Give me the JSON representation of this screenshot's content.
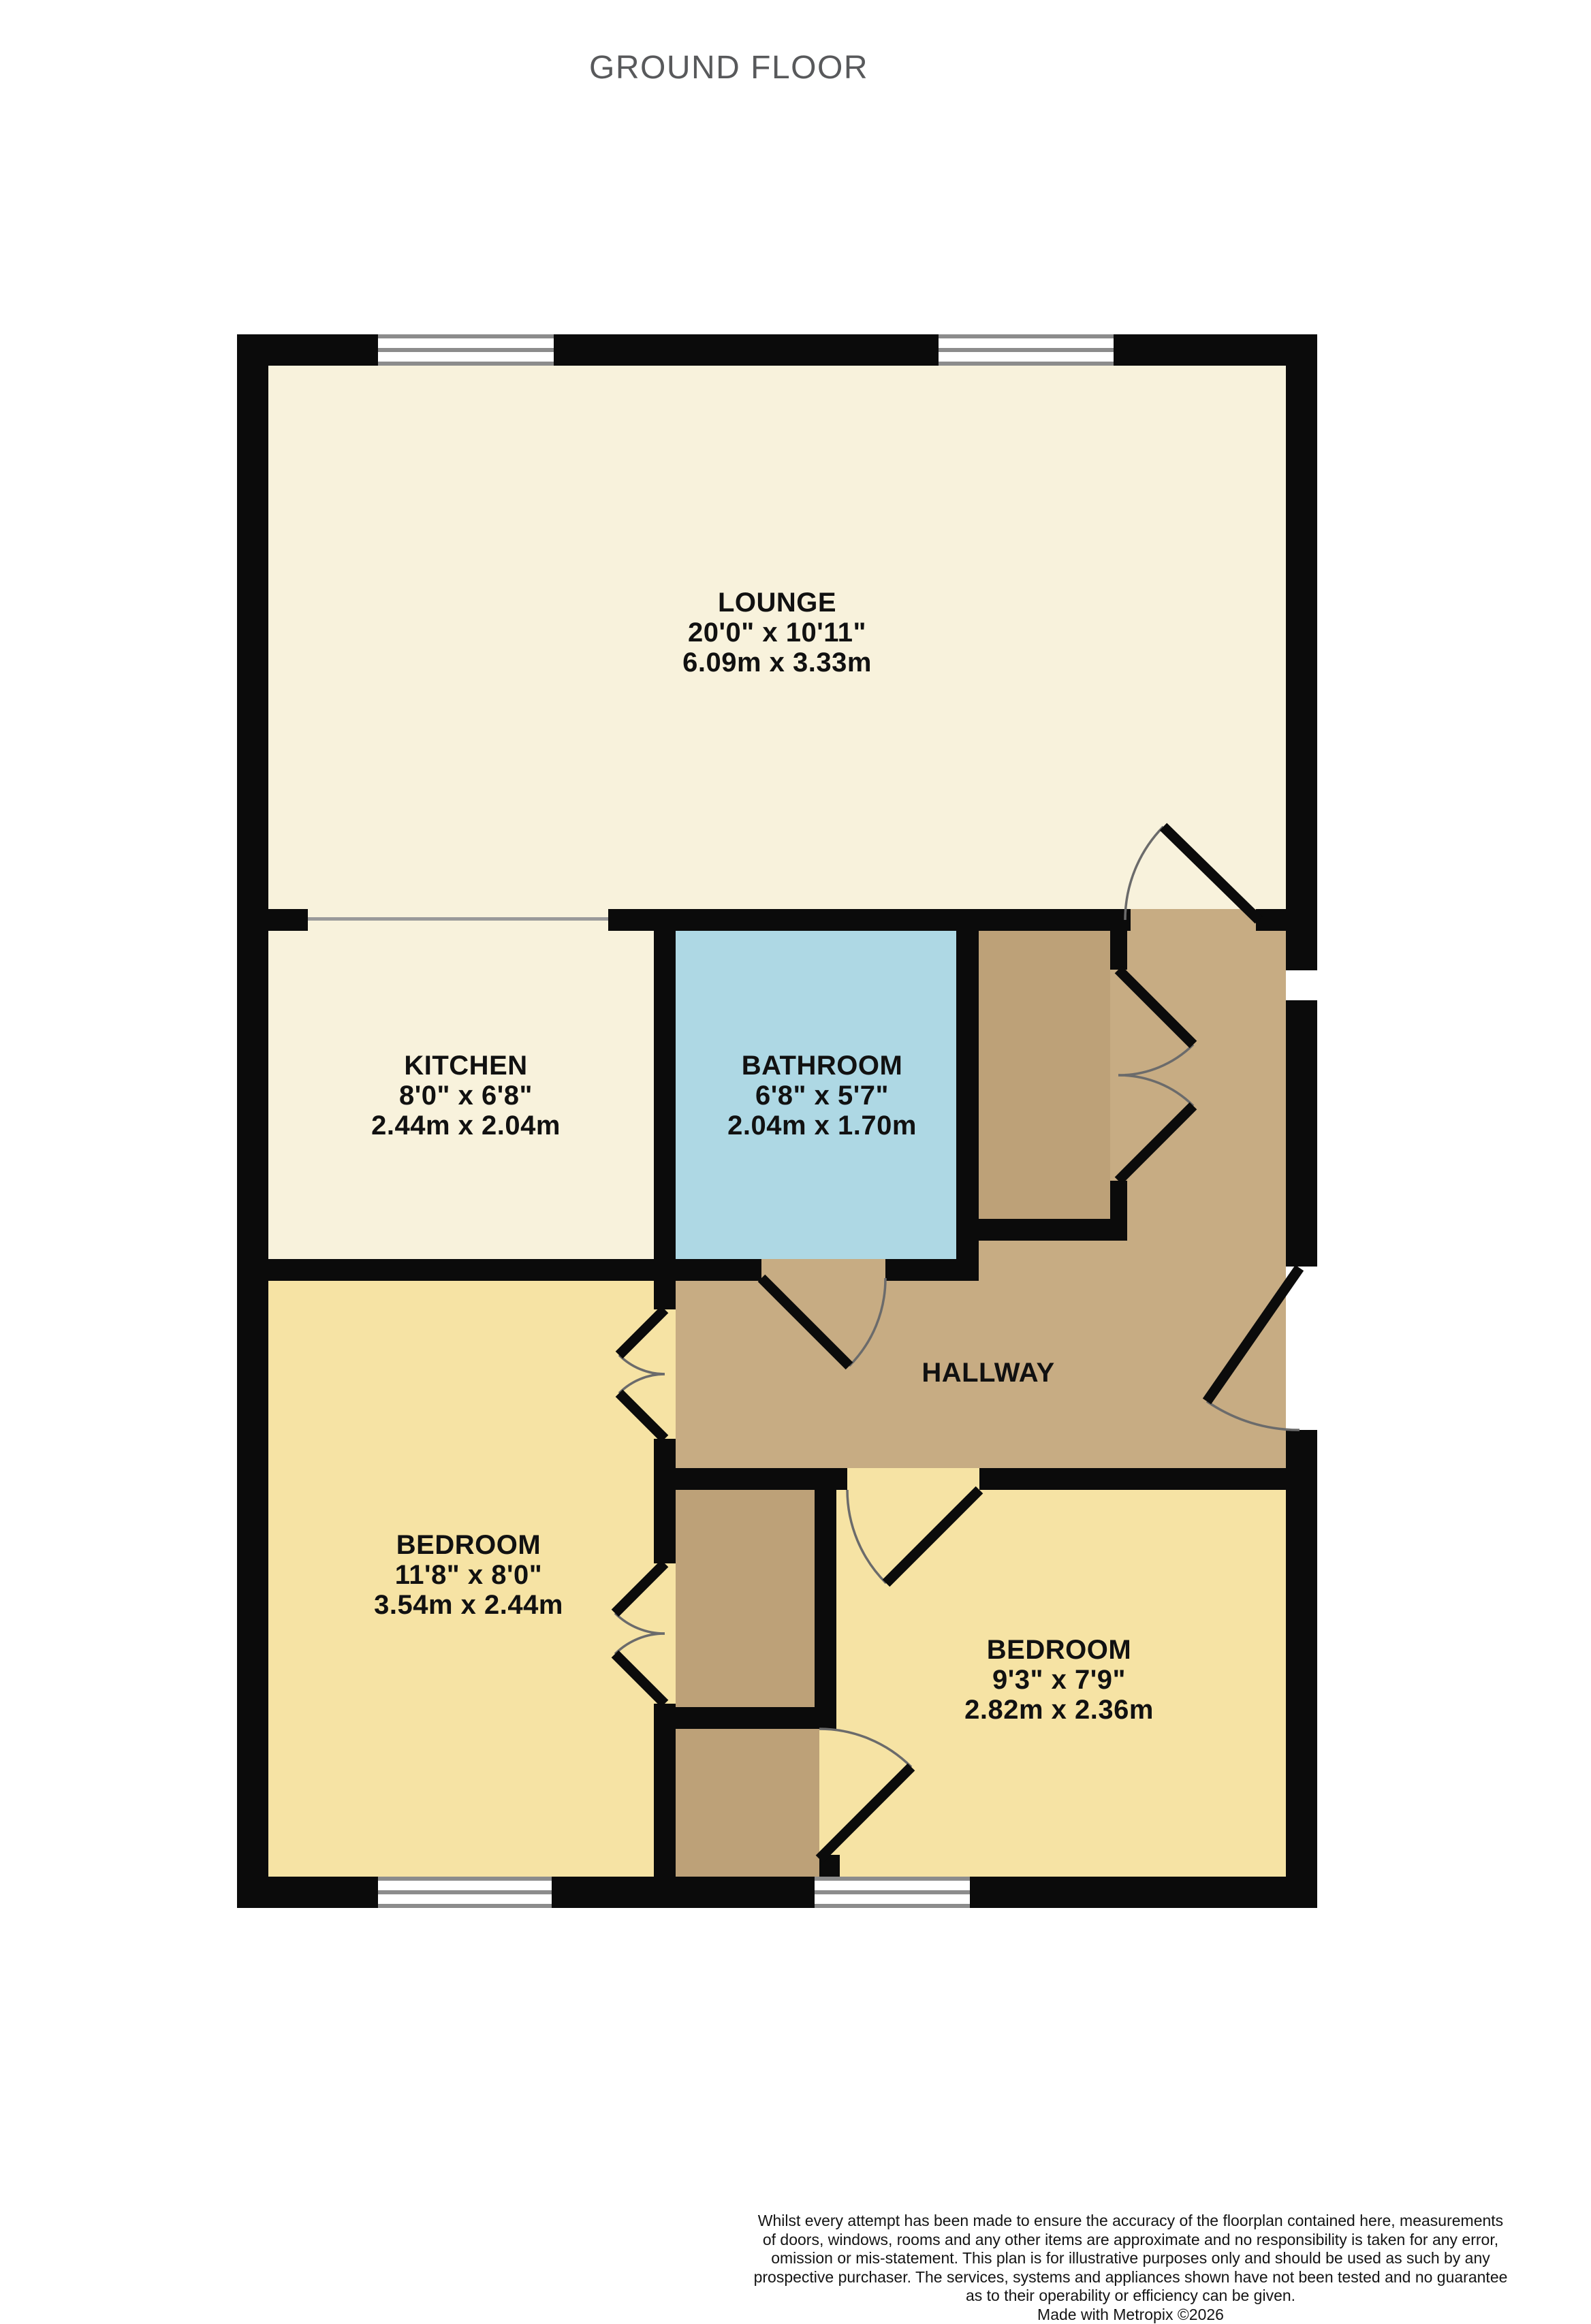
{
  "title": "GROUND FLOOR",
  "colors": {
    "wall": "#0b0b0b",
    "cream": "#f8f2dc",
    "blue": "#aed8e4",
    "tan": "#c7ac83",
    "cupboard_tan": "#bda178",
    "yellow": "#f6e3a4",
    "window_frame": "#8c8c8c",
    "title_gray": "#58595b"
  },
  "rooms": {
    "lounge": {
      "name": "LOUNGE",
      "imperial": "20'0\"  x 10'11\"",
      "metric": "6.09m  x 3.33m"
    },
    "kitchen": {
      "name": "KITCHEN",
      "imperial": "8'0\"  x 6'8\"",
      "metric": "2.44m  x 2.04m"
    },
    "bathroom": {
      "name": "BATHROOM",
      "imperial": "6'8\"  x 5'7\"",
      "metric": "2.04m  x 1.70m"
    },
    "hallway": {
      "name": "HALLWAY"
    },
    "bedroom1": {
      "name": "BEDROOM",
      "imperial": "11'8\"  x 8'0\"",
      "metric": "3.54m  x 2.44m"
    },
    "bedroom2": {
      "name": "BEDROOM",
      "imperial": "9'3\"  x 7'9\"",
      "metric": "2.82m  x 2.36m"
    }
  },
  "footer": {
    "lines": [
      "Whilst every attempt has been made to ensure the accuracy of the floorplan contained here, measurements",
      "of doors, windows, rooms and any other items are approximate and no responsibility is taken for any error,",
      "omission or mis-statement. This plan is for illustrative purposes only and should be used as such by any",
      "prospective purchaser. The services, systems and appliances shown have not been tested and no guarantee",
      "as to their operability or efficiency can be given."
    ],
    "credit": "Made with Metropix ©2026"
  }
}
